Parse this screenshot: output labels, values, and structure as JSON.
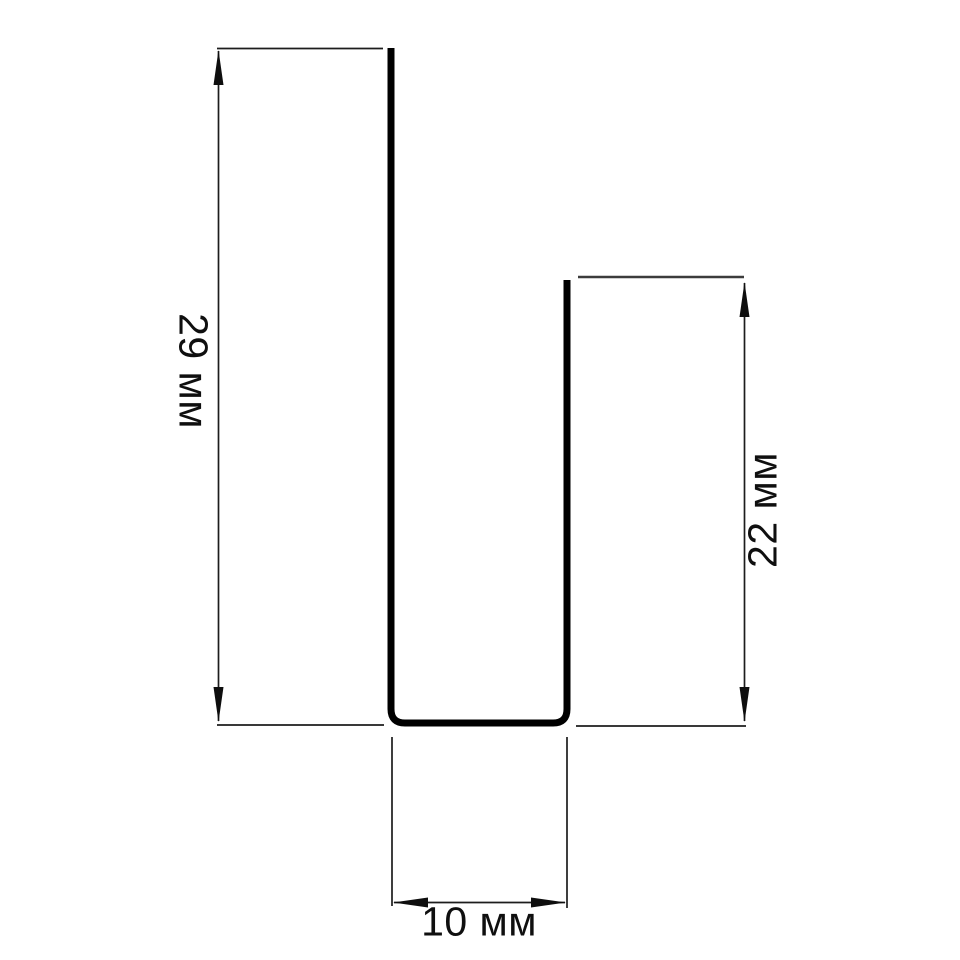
{
  "diagram": {
    "kind": "technical-dimension-drawing",
    "subject": "u-shaped-profile-cross-section",
    "units": "мм",
    "background_color": "#ffffff",
    "profile_color": "#000000",
    "dimension_line_color": "#1d1d1d",
    "text_color": "#0f0f0f",
    "dimensions": {
      "left_height": {
        "value": 29,
        "unit": "мм",
        "label": "29 мм",
        "side": "left",
        "text_rotation_deg": 90
      },
      "right_height": {
        "value": 22,
        "unit": "мм",
        "label": "22 мм",
        "side": "right",
        "text_rotation_deg": -90
      },
      "bottom_width": {
        "value": 10,
        "unit": "мм",
        "label": "10 мм",
        "side": "bottom",
        "text_rotation_deg": 0
      }
    }
  }
}
